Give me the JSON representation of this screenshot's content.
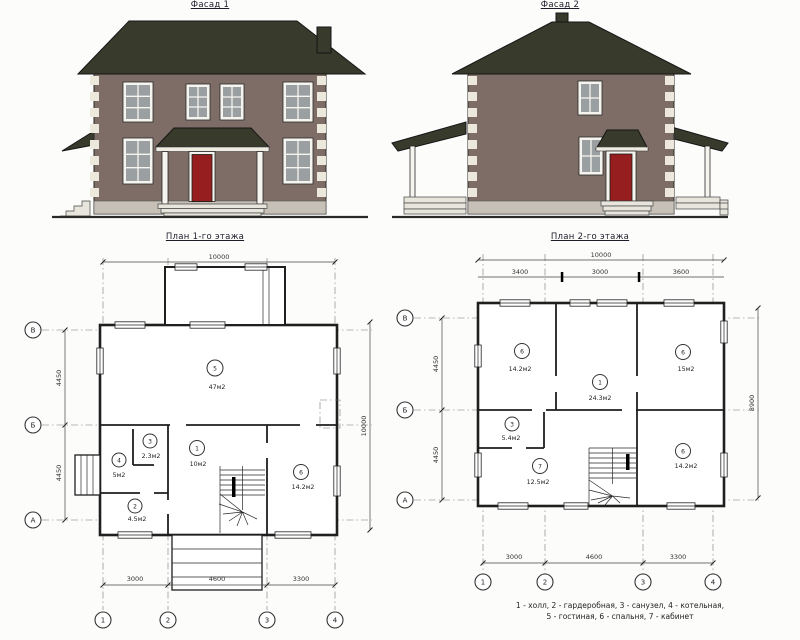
{
  "facade1": {
    "title": "Фасад 1"
  },
  "facade2": {
    "title": "Фасад 2"
  },
  "plan1": {
    "title": "План 1-го этажа",
    "dims": {
      "top_total": "10000",
      "bottom": [
        "3000",
        "4600",
        "3300"
      ],
      "left": [
        "4450",
        "4450"
      ],
      "right_total": "10000"
    },
    "grid_cols": [
      "1",
      "2",
      "3",
      "4"
    ],
    "grid_rows": [
      "В",
      "Б",
      "А"
    ],
    "rooms": [
      {
        "num": "5",
        "area": "47м2"
      },
      {
        "num": "4",
        "area": "5м2"
      },
      {
        "num": "3",
        "area": "2.3м2"
      },
      {
        "num": "1",
        "area": "10м2"
      },
      {
        "num": "2",
        "area": "4.5м2"
      },
      {
        "num": "6",
        "area": "14.2м2"
      }
    ]
  },
  "plan2": {
    "title": "План 2-го этажа",
    "dims": {
      "top_total": "10000",
      "top_segments": [
        "3400",
        "3000",
        "3600"
      ],
      "bottom": [
        "3000",
        "4600",
        "3300"
      ],
      "left": [
        "4450",
        "4450"
      ],
      "right_total": "8900"
    },
    "grid_cols": [
      "1",
      "2",
      "3",
      "4"
    ],
    "grid_rows": [
      "В",
      "Б",
      "А"
    ],
    "rooms": [
      {
        "num": "6",
        "area": "14.2м2"
      },
      {
        "num": "1",
        "area": "24.3м2"
      },
      {
        "num": "6",
        "area": "15м2"
      },
      {
        "num": "3",
        "area": "5.4м2"
      },
      {
        "num": "7",
        "area": "12.5м2"
      },
      {
        "num": "6",
        "area": "14.2м2"
      }
    ]
  },
  "legend": {
    "line1": "1 - холл, 2 - гардеробная, 3 - санузел, 4 - котельная,",
    "line2": "5 - гостиная, 6 - спальня, 7 - кабинет"
  },
  "colors": {
    "wall": "#7d6d66",
    "roof": "#383a2c",
    "door": "#971e1e",
    "quoin": "#ece8dc",
    "foundation": "#c6c0b6",
    "pane": "#9aa0a2",
    "line": "#2a2a2a",
    "paper": "#fcfcfb"
  }
}
